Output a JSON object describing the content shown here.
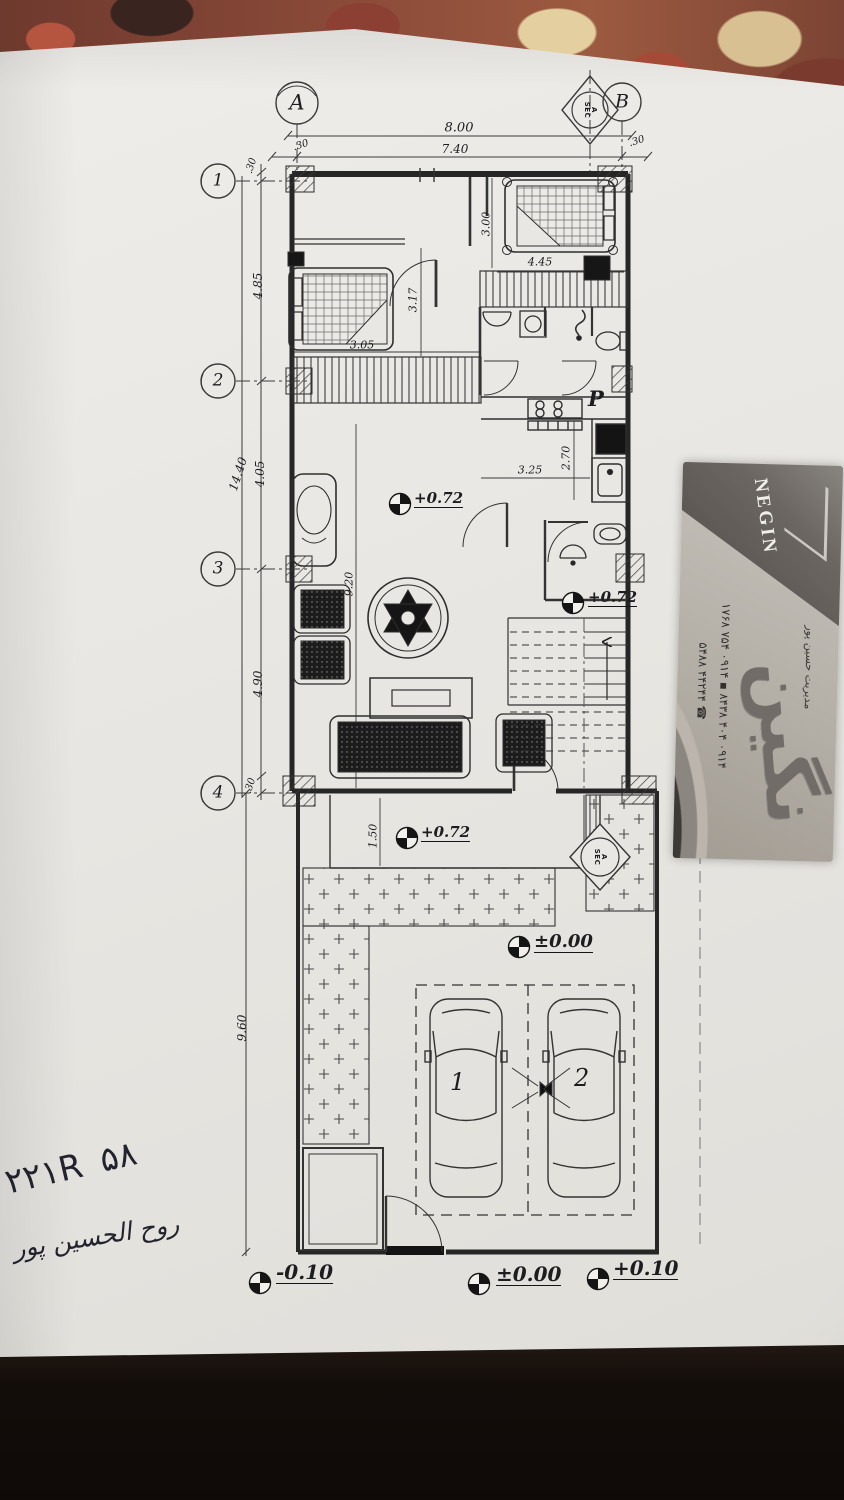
{
  "plan": {
    "grid": {
      "columns": [
        "A",
        "B"
      ],
      "rows": [
        "1",
        "2",
        "3",
        "4"
      ]
    },
    "section_marker": {
      "line1": "A",
      "line2": "SEC"
    },
    "dimensions": {
      "top_total": "8.00",
      "top_clear": "7.40",
      "wall_offset": ".30",
      "left_total": "14.40",
      "left_seg_1_2": "4.85",
      "left_seg_2_3": "4.05",
      "left_seg_3_4": "4.90",
      "left_lower": "9.60",
      "bedroom2_depth": "3.00",
      "bedroom2_width": "4.45",
      "hall_depth": "3.17",
      "closet_width": "3.05",
      "kitchen_depth": "2.70",
      "kitchen_width": "3.25",
      "living_length": "9.20",
      "porch_depth": "1.50"
    },
    "levels": {
      "ground_floor": "+0.72",
      "yard": "±0.00",
      "front_right": "+0.10",
      "front_left": "-0.10"
    },
    "labels": {
      "kitchen": "P",
      "car_1": "1",
      "car_2": "2"
    }
  },
  "card": {
    "latin_name": "NEGIN",
    "persian_name": "نگین",
    "manager": "مدیریت حسین پور",
    "phone_line_1": "۰۹۱۴ ۴۰۴ ۸۴۳۸",
    "phone_line_2": "۰۹۱۴ ۷۵۴ ۱۷۶۸",
    "phone_line_3": "۴۴۲۴۴ ۵۴۸۸"
  },
  "handwriting": {
    "line_1": "۲۲۱R ۵۸",
    "line_2": "روح الحسين پور"
  }
}
